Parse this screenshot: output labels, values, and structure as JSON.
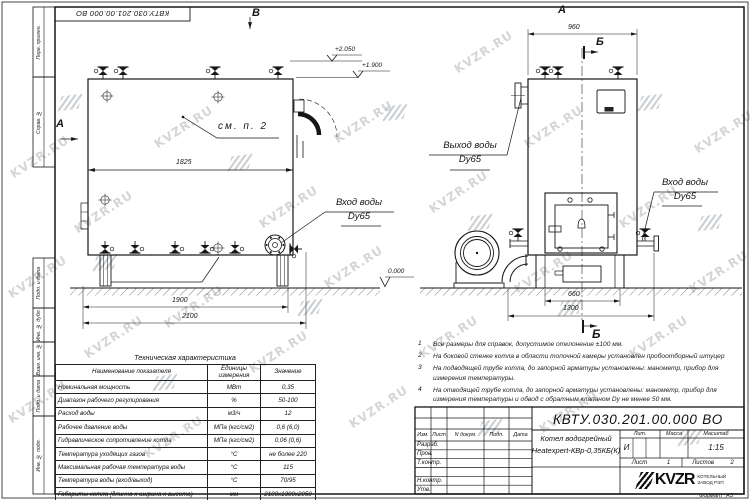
{
  "watermark": {
    "text": "KVZR.RU"
  },
  "frame": {
    "top_stamp": "КВТУ.030.201.00.000  ВО",
    "left_stamps": [
      "Перв. примен.",
      "Справ. №",
      "Подп. и дата",
      "Инв. № дубл.",
      "Взам. инв. №",
      "Подп. и дата",
      "Инв. № подл."
    ]
  },
  "views": {
    "label_a": "А",
    "label_b": "Б",
    "label_v": "В",
    "see_note": "см. п. 2",
    "inlet_left": {
      "line1": "Вход воды",
      "line2": "Dy65"
    },
    "outlet": {
      "line1": "Выход воды",
      "line2": "Dy65"
    },
    "inlet_right": {
      "line1": "Вход воды",
      "line2": "Dy65"
    },
    "elevations": {
      "top": "+2.050",
      "mid": "+1.900",
      "zero": "0.000"
    },
    "dims": {
      "d1825": "1825",
      "d1900": "1900",
      "d2100": "2100",
      "d960": "960",
      "d660": "660",
      "d1300": "1300"
    }
  },
  "notes": [
    {
      "num": "1",
      "text": "Все размеры для справок, допустимое отклонение ±100 мм."
    },
    {
      "num": "2",
      "text": "На боковой стенке котла в области топочной камеры установлен пробоотборный штуцер"
    },
    {
      "num": "3",
      "text": "На  подводящей трубе котла, до запорной арматуры установлены: манометр, прибор для измерения температуры."
    },
    {
      "num": "4",
      "text": "На отводящей трубе котла, до запорной арматуры установлены: манометр, прибор для измерения температуры и обвод с обратным клапаном Dy не менее 50 мм."
    }
  ],
  "tech_table": {
    "title": "Техническая характеристика",
    "headers": [
      "Наименование показателя",
      "Единицы измерения",
      "Значение"
    ],
    "rows": [
      [
        "Номинальная мощность",
        "МВт",
        "0,35"
      ],
      [
        "Диапазон рабочего регулирования",
        "%",
        "50-100"
      ],
      [
        "Расход воды",
        "м3/ч",
        "12"
      ],
      [
        "Рабочее давление воды",
        "МПа (кгс/см2)",
        "0,6 (6,0)"
      ],
      [
        "Гидравлическое сопротивление котла",
        "МПа (кгс/см2)",
        "0,06 (0,6)"
      ],
      [
        "Температура уходящих газов",
        "°С",
        "не более 220"
      ],
      [
        "Максимальная рабочая температура воды",
        "°С",
        "115"
      ],
      [
        "Температура воды (вход/выход)",
        "°С",
        "70/95"
      ],
      [
        "Габариты котла (длинна х ширина х высота)",
        "мм",
        "2100х1300х2050"
      ]
    ]
  },
  "title_block": {
    "doc_number": "КВТУ.030.201.00.000  ВО",
    "rev_headers": [
      "Изм.",
      "Лист",
      "N докум.",
      "Подп.",
      "Дата"
    ],
    "roles": [
      "Разраб.",
      "Пров.",
      "Т.контр.",
      "Н.контр.",
      "Утв."
    ],
    "product_name_line1": "Котел водогрейный",
    "product_name_line2": "Heatexpert-КВр-0,35КБ(К)",
    "lit_header": "Лит.",
    "mass_header": "Масса",
    "scale_header": "Масштаб",
    "lit_value": "И",
    "scale_value": "1:15",
    "sheet_label": "Лист",
    "sheet_value": "1",
    "sheets_label": "Листов",
    "sheets_value": "2",
    "company_logo": "KVZR",
    "company_name_line1": "КОТЕЛЬНЫЙ",
    "company_name_line2": "ЗАВОД РЭП",
    "format_label": "Формат",
    "format_value": "А3"
  }
}
